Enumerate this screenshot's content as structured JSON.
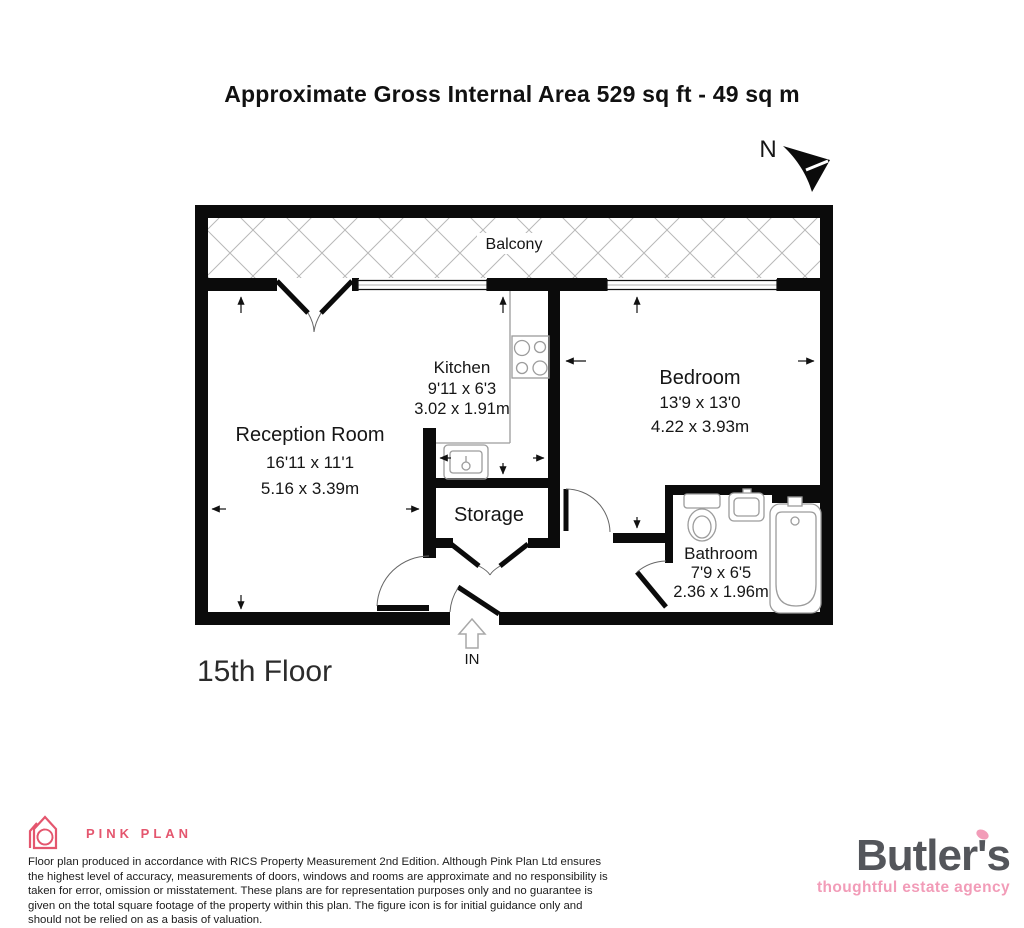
{
  "title": "Approximate Gross Internal Area 529 sq ft - 49 sq m",
  "compass": {
    "north_label": "N"
  },
  "plan": {
    "balcony": {
      "label": "Balcony"
    },
    "reception": {
      "name": "Reception Room",
      "imperial": "16'11 x 11'1",
      "metric": "5.16 x 3.39m"
    },
    "kitchen": {
      "name": "Kitchen",
      "imperial": "9'11 x 6'3",
      "metric": "3.02 x 1.91m"
    },
    "bedroom": {
      "name": "Bedroom",
      "imperial": "13'9 x 13'0",
      "metric": "4.22 x 3.93m"
    },
    "storage": {
      "name": "Storage"
    },
    "bathroom": {
      "name": "Bathroom",
      "imperial": "7'9 x 6'5",
      "metric": "2.36 x 1.96m"
    },
    "entrance": {
      "label": "IN"
    },
    "floor": {
      "label": "15th Floor"
    }
  },
  "footer": {
    "pink_plan": {
      "brand": "PINK PLAN",
      "accent_color": "#e4566e"
    },
    "disclaimer": "Floor plan produced in accordance with RICS Property Measurement 2nd Edition. Although Pink Plan Ltd ensures the highest level of accuracy, measurements of doors, windows and rooms are approximate and no responsibility is taken for error, omission or misstatement. These plans are for representation purposes only and no guarantee is given on the total square footage of the property within this plan. The figure icon is for initial guidance only and should not be relied on as a basis of valuation.",
    "butlers": {
      "brand": "Butler's",
      "tagline": "thoughtful estate agency",
      "brand_color": "#54565B",
      "accent_color": "#F29CB8"
    }
  }
}
